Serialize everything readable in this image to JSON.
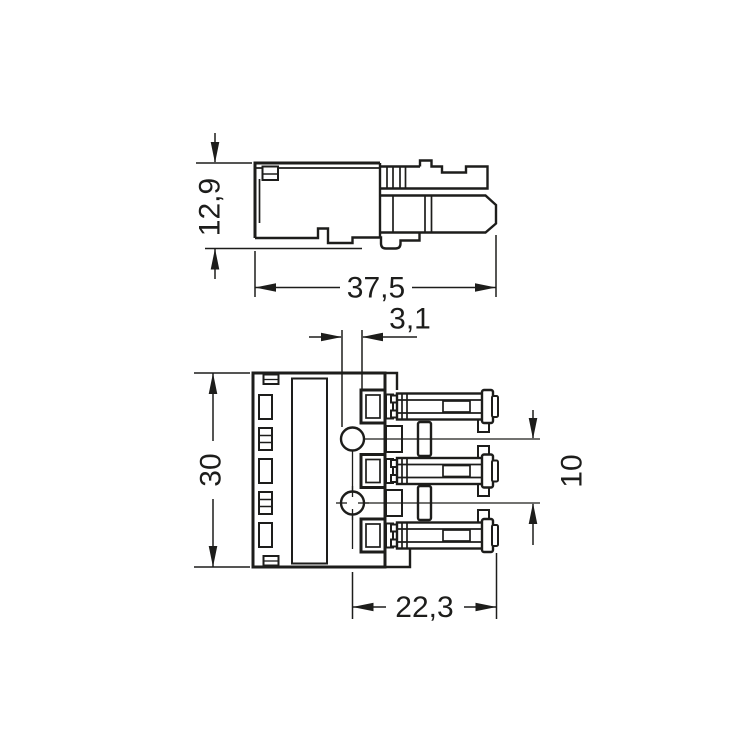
{
  "colors": {
    "background": "#ffffff",
    "line": "#1d1d1b",
    "button_orange": "#efa963"
  },
  "side_view": {
    "dims": {
      "height": "12,9",
      "width": "37,5"
    }
  },
  "front_view": {
    "dims": {
      "notch_offset": "3,1",
      "height": "30",
      "pole_pitch": "10",
      "depth": "22,3"
    }
  }
}
